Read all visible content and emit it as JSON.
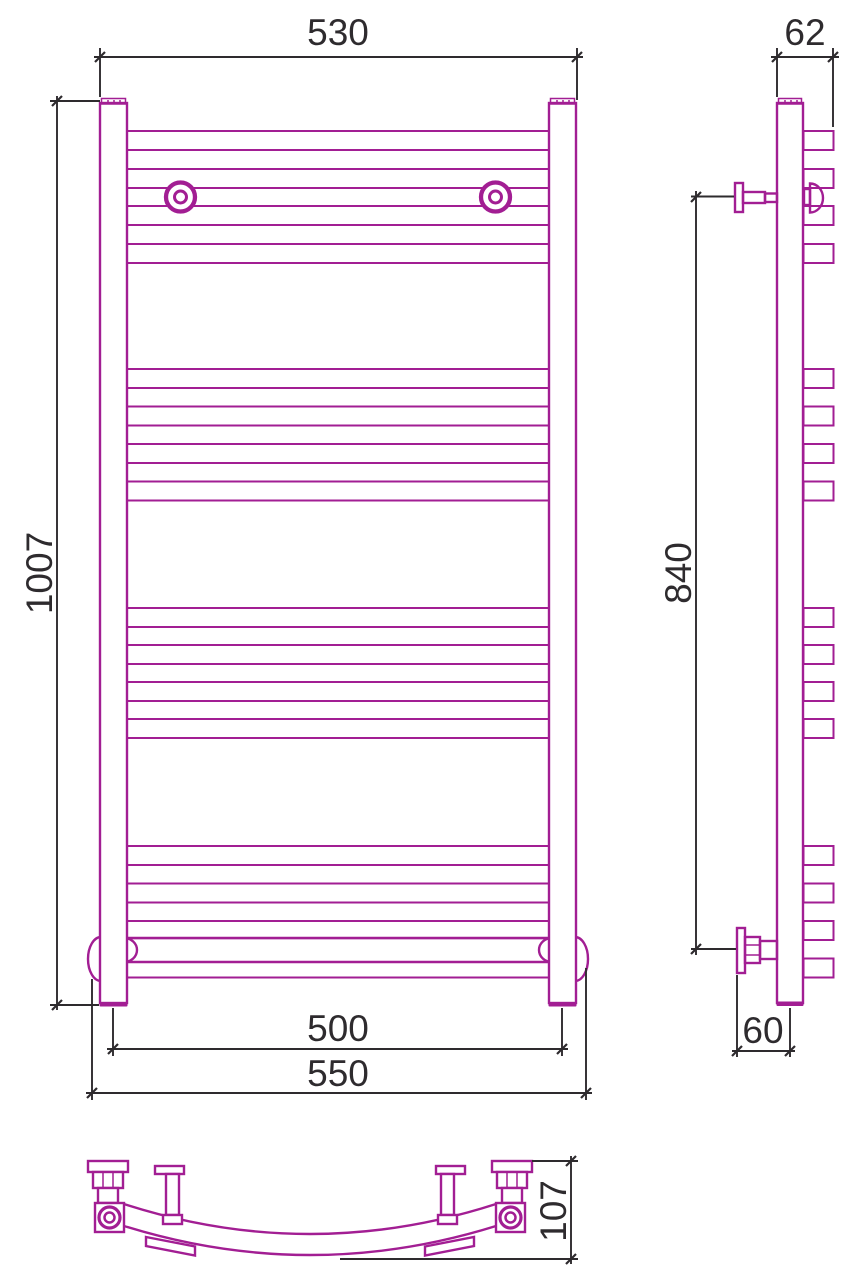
{
  "document": {
    "type": "technical-drawing",
    "subject": "ladder towel radiator, three orthographic views"
  },
  "colors": {
    "line": "#A21E93",
    "dimension": "#2e2b2e",
    "background": "#ffffff"
  },
  "dimensions": {
    "front_width_top": "530",
    "front_height": "1007",
    "front_axis_span": "500",
    "front_overall_width": "550",
    "side_depth_top": "62",
    "side_bracket_span": "840",
    "side_wall_offset": "60",
    "bottom_arc_depth": "107"
  },
  "drawing": {
    "rung_h": 19,
    "rung_rows_y": [
      131,
      169,
      206,
      244,
      369,
      406.5,
      444,
      481.5,
      608,
      645,
      682,
      719,
      846,
      883.5,
      921,
      958.5
    ],
    "front": {
      "x": 127,
      "w": 422
    },
    "side": {
      "x": 803.5,
      "w": 30
    }
  }
}
